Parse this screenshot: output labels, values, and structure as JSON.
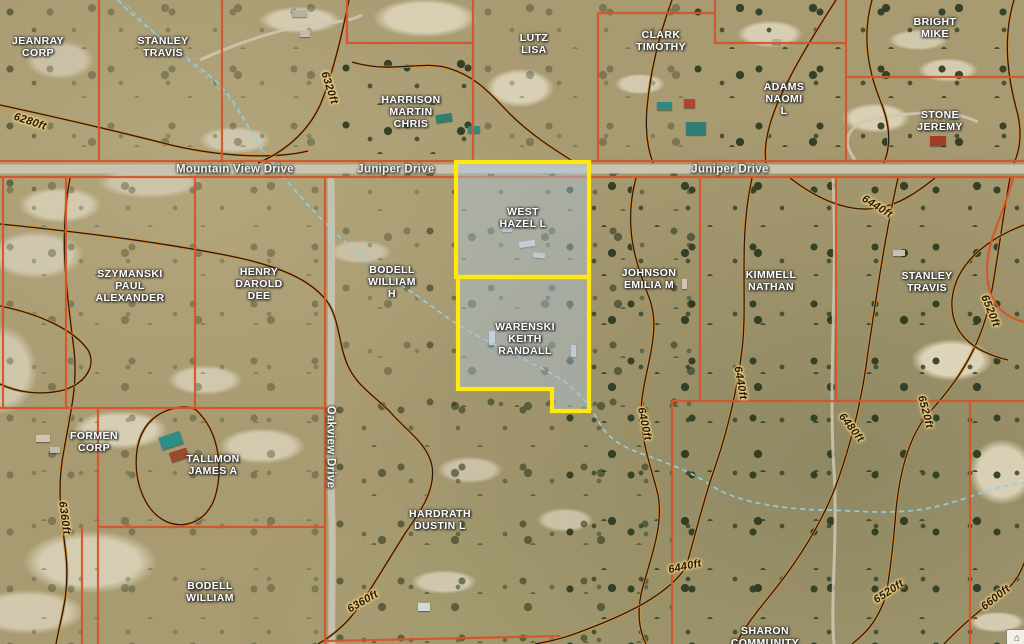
{
  "map": {
    "description": "County GIS aerial parcel map with ownership labels, topographic contours and a selected property highlighted in yellow",
    "colors": {
      "parcel_line": "#d4552b",
      "selection_outline": "#ffe70f",
      "selection_fill": "rgba(173,194,216,0.48)",
      "contour_casing": "#d29044",
      "contour_core": "#2a1d0d",
      "stream": "#8fd0e8",
      "road_surface": "#c9c3b2"
    },
    "selection": {
      "highlight_color": "#ffe70f",
      "parcels": [
        {
          "owner": "WEST HAZEL L",
          "points": [
            [
              456,
              162
            ],
            [
              589,
              162
            ],
            [
              589,
              277
            ],
            [
              456,
              277
            ]
          ]
        },
        {
          "owner": "WARENSKI KEITH RANDALL",
          "points": [
            [
              458,
              277
            ],
            [
              589,
              277
            ],
            [
              589,
              411
            ],
            [
              552,
              411
            ],
            [
              552,
              389
            ],
            [
              458,
              389
            ]
          ]
        }
      ]
    },
    "parcel_labels": [
      {
        "label": "JEANRAY\nCORP",
        "x": 38,
        "y": 48,
        "selected": false
      },
      {
        "label": "STANLEY\nTRAVIS",
        "x": 163,
        "y": 48,
        "selected": false
      },
      {
        "label": "LUTZ\nLISA",
        "x": 534,
        "y": 45,
        "selected": false
      },
      {
        "label": "CLARK\nTIMOTHY",
        "x": 661,
        "y": 42,
        "selected": false
      },
      {
        "label": "BRIGHT\nMIKE",
        "x": 935,
        "y": 29,
        "selected": false
      },
      {
        "label": "HARRISON\nMARTIN\nCHRIS",
        "x": 411,
        "y": 113,
        "selected": false
      },
      {
        "label": "ADAMS\nNAOMI\nL",
        "x": 784,
        "y": 100,
        "selected": false
      },
      {
        "label": "STONE\nJEREMY",
        "x": 940,
        "y": 122,
        "selected": false
      },
      {
        "label": "WEST\nHAZEL L",
        "x": 523,
        "y": 219,
        "selected": true
      },
      {
        "label": "SZYMANSKI\nPAUL\nALEXANDER",
        "x": 130,
        "y": 287,
        "selected": false
      },
      {
        "label": "HENRY\nDAROLD\nDEE",
        "x": 259,
        "y": 285,
        "selected": false
      },
      {
        "label": "BODELL\nWILLIAM\nH",
        "x": 392,
        "y": 283,
        "selected": false
      },
      {
        "label": "JOHNSON\nEMILIA M",
        "x": 649,
        "y": 280,
        "selected": false
      },
      {
        "label": "KIMMELL\nNATHAN",
        "x": 771,
        "y": 282,
        "selected": false
      },
      {
        "label": "STANLEY\nTRAVIS",
        "x": 927,
        "y": 283,
        "selected": false
      },
      {
        "label": "WARENSKI\nKEITH\nRANDALL",
        "x": 525,
        "y": 340,
        "selected": true
      },
      {
        "label": "FORMEN\nCORP",
        "x": 94,
        "y": 443,
        "selected": false
      },
      {
        "label": "TALLMON\nJAMES A",
        "x": 213,
        "y": 466,
        "selected": false
      },
      {
        "label": "HARDRATH\nDUSTIN L",
        "x": 440,
        "y": 521,
        "selected": false
      },
      {
        "label": "BODELL\nWILLIAM",
        "x": 210,
        "y": 593,
        "selected": false
      },
      {
        "label": "SHARON\nCOMMUNITY",
        "x": 765,
        "y": 638,
        "selected": false
      }
    ],
    "road_labels": [
      {
        "label": "Mountain View Drive",
        "x": 235,
        "y": 170,
        "rot": 0
      },
      {
        "label": "Juniper Drive",
        "x": 396,
        "y": 170,
        "rot": 0
      },
      {
        "label": "Juniper Drive",
        "x": 730,
        "y": 170,
        "rot": 0
      },
      {
        "label": "Oakview Drive",
        "x": 330,
        "y": 447,
        "rot": 90
      }
    ],
    "contour_labels": [
      {
        "label": "6280ft",
        "x": 30,
        "y": 122,
        "rot": 18
      },
      {
        "label": "6320ft",
        "x": 329,
        "y": 88,
        "rot": 72
      },
      {
        "label": "6440ft",
        "x": 877,
        "y": 207,
        "rot": 32
      },
      {
        "label": "6400ft",
        "x": 644,
        "y": 424,
        "rot": 78
      },
      {
        "label": "6440ft",
        "x": 740,
        "y": 383,
        "rot": 80
      },
      {
        "label": "6480ft",
        "x": 851,
        "y": 428,
        "rot": 52
      },
      {
        "label": "6520ft",
        "x": 990,
        "y": 311,
        "rot": 68
      },
      {
        "label": "6520ft",
        "x": 925,
        "y": 412,
        "rot": 75
      },
      {
        "label": "6360ft",
        "x": 64,
        "y": 518,
        "rot": 82
      },
      {
        "label": "6360ft",
        "x": 363,
        "y": 602,
        "rot": -30
      },
      {
        "label": "6440ft",
        "x": 685,
        "y": 567,
        "rot": -12
      },
      {
        "label": "6520ft",
        "x": 889,
        "y": 592,
        "rot": -33
      },
      {
        "label": "6600ft",
        "x": 996,
        "y": 598,
        "rot": -38
      }
    ],
    "watermark": {
      "glyph": "⌂"
    }
  }
}
